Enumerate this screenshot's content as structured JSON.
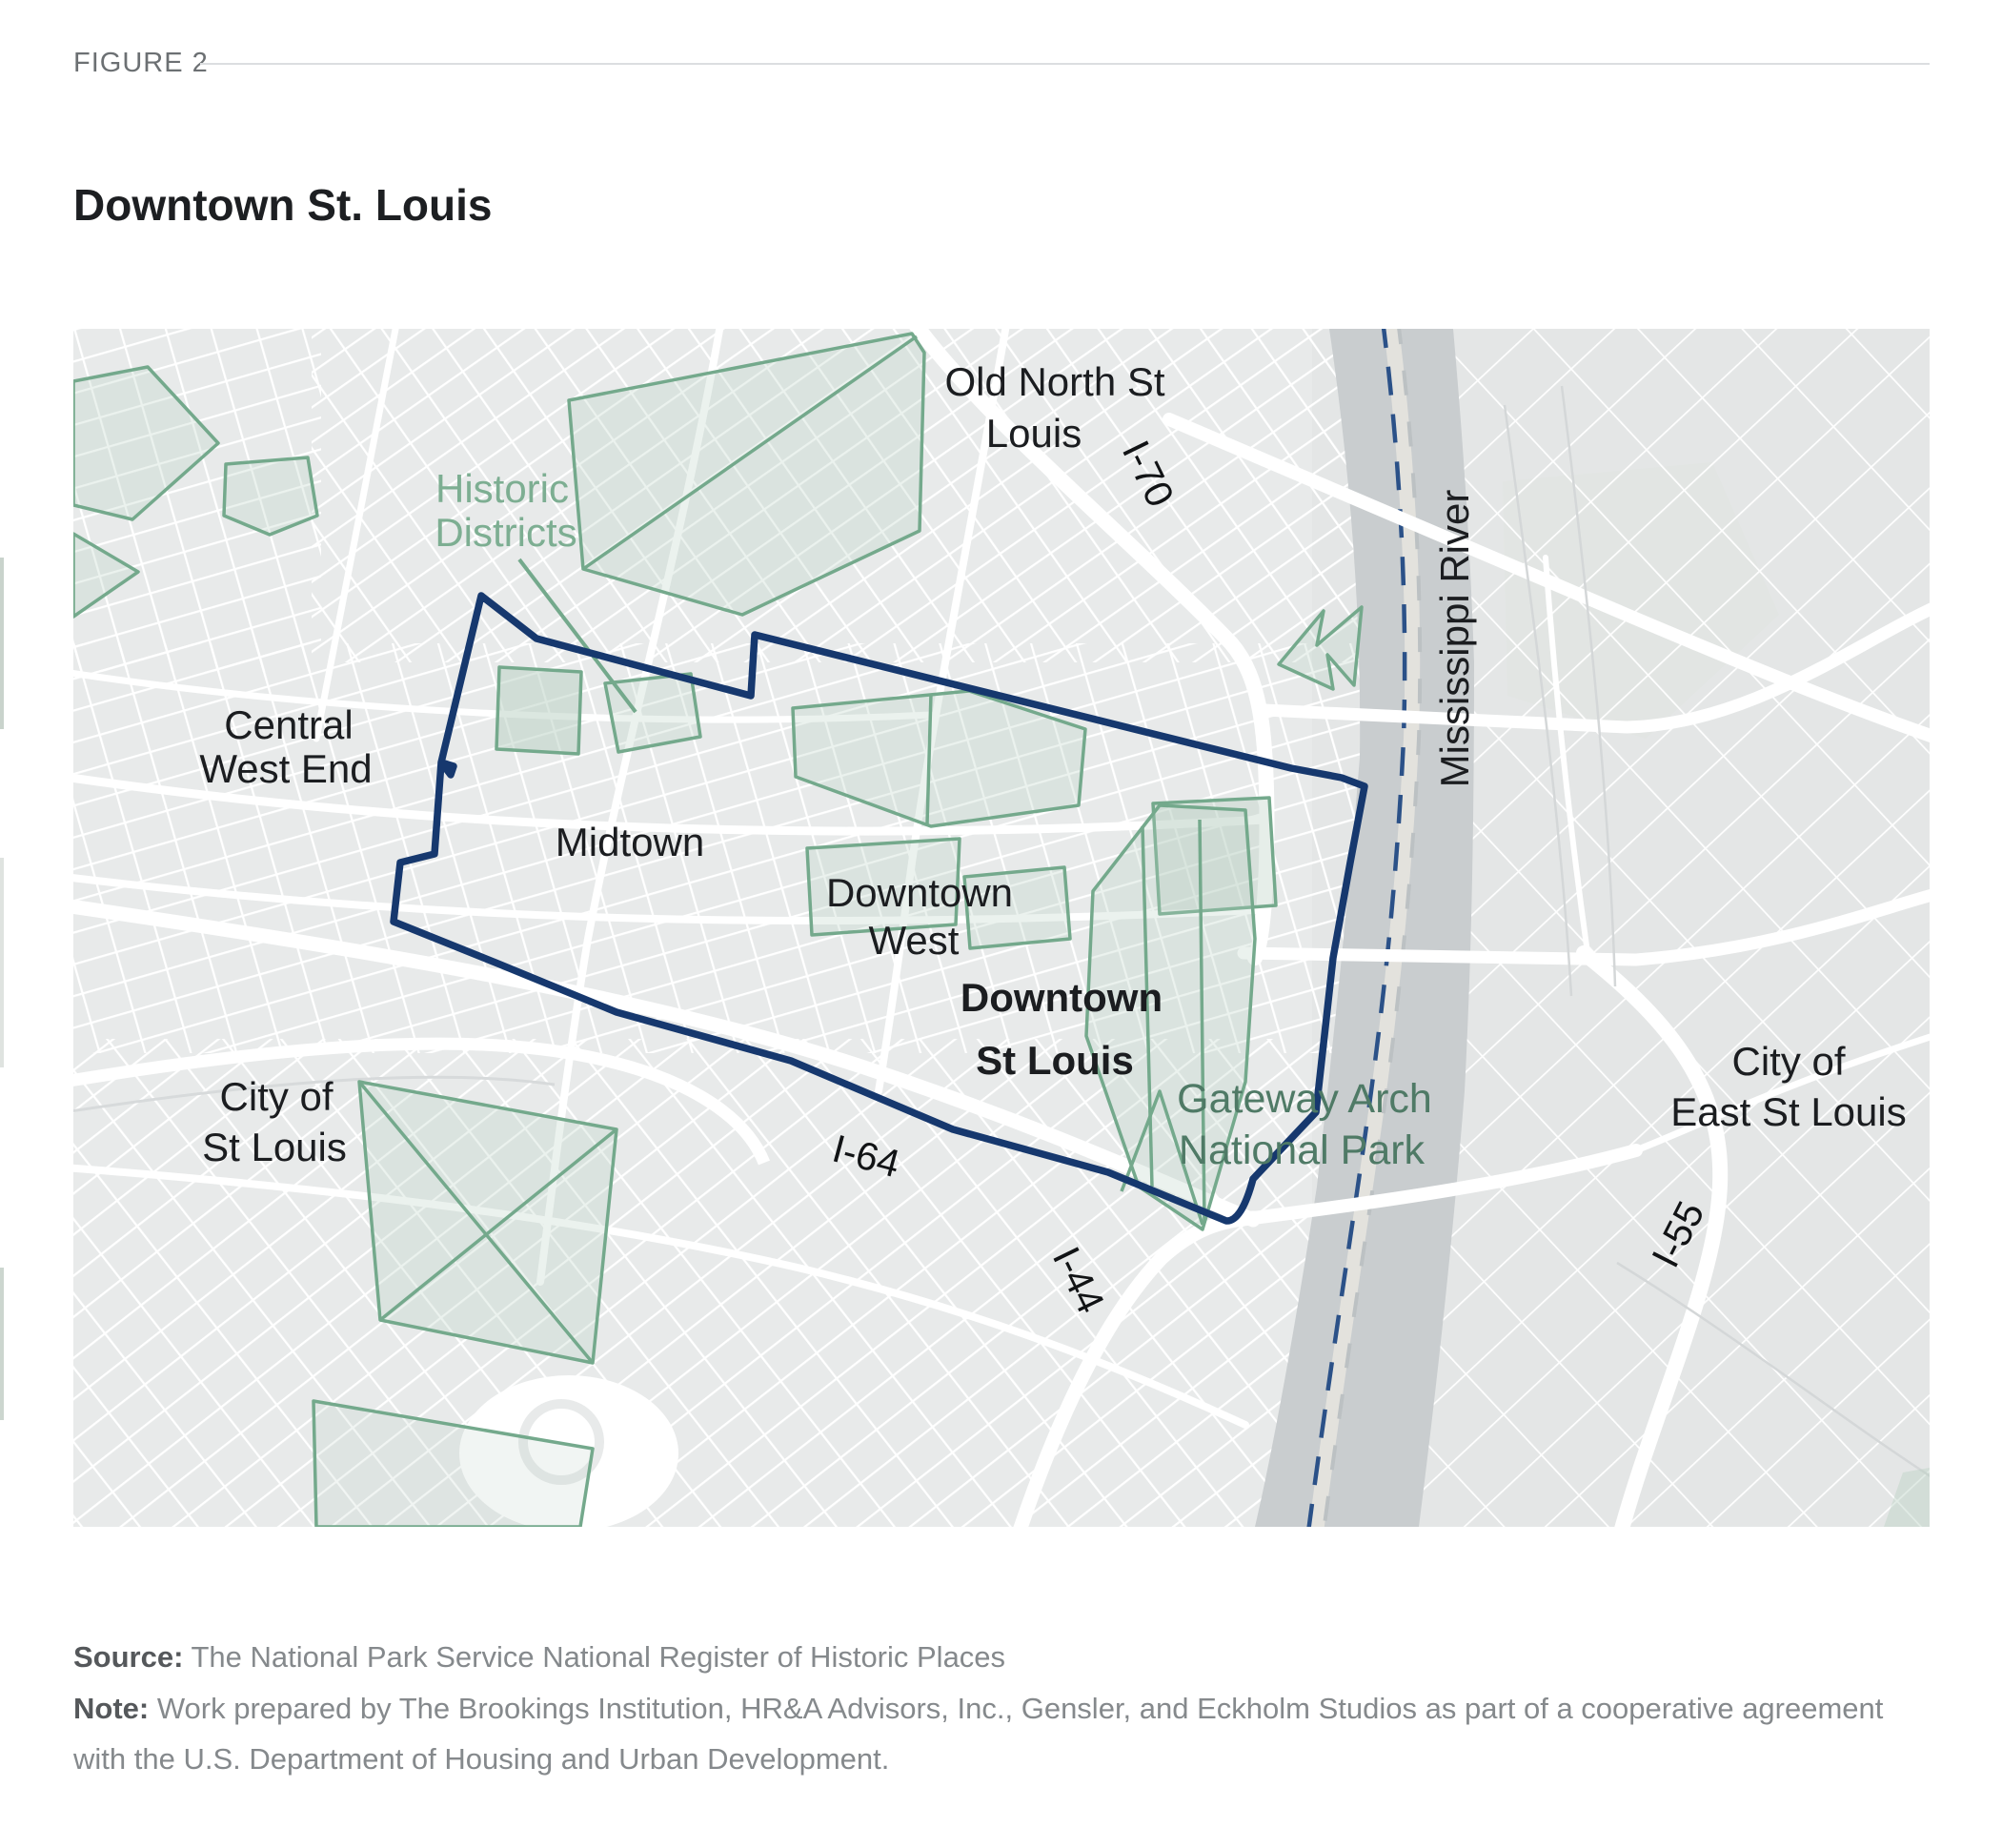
{
  "header": {
    "figure_label": "FIGURE 2",
    "title": "Downtown St. Louis"
  },
  "map": {
    "labels": {
      "old_north": {
        "lines": [
          "Old North St",
          "Louis"
        ]
      },
      "historic_districts": {
        "lines": [
          "Historic",
          "Districts"
        ]
      },
      "central_west_end": {
        "lines": [
          "Central",
          "West End"
        ]
      },
      "midtown": {
        "lines": [
          "Midtown"
        ]
      },
      "downtown_west": {
        "lines": [
          "Downtown",
          "West"
        ]
      },
      "downtown_st_louis": {
        "lines": [
          "Downtown",
          "St Louis"
        ]
      },
      "gateway_arch": {
        "lines": [
          "Gateway Arch",
          "National Park"
        ]
      },
      "city_of_st_louis": {
        "lines": [
          "City of",
          "St Louis"
        ]
      },
      "city_of_east_st_louis": {
        "lines": [
          "City of",
          "East St Louis"
        ]
      },
      "mississippi_river": {
        "lines": [
          "Mississippi River"
        ]
      },
      "i70": {
        "lines": [
          "I-70"
        ]
      },
      "i64": {
        "lines": [
          "I-64"
        ]
      },
      "i44": {
        "lines": [
          "I-44"
        ]
      },
      "i55": {
        "lines": [
          "I-55"
        ]
      }
    },
    "colors": {
      "boundary_navy": "#16386e",
      "historic_outline_green": "#74a98c",
      "historic_label_green": "#7dae92",
      "park_label_green": "#4f7a66",
      "river_gray": "#c9cdcf",
      "land_gray": "#e8eaea",
      "east_land_gray": "#e4e6e6",
      "street_white": "#ffffff"
    }
  },
  "footer": {
    "source_label": "Source:",
    "source_text": " The National Park Service National Register of Historic Places",
    "note_label": "Note:",
    "note_text": " Work prepared by The Brookings Institution, HR&A Advisors, Inc., Gensler, and Eckholm Studios as part of a cooperative agreement with the U.S. Department of Housing and Urban Development."
  }
}
